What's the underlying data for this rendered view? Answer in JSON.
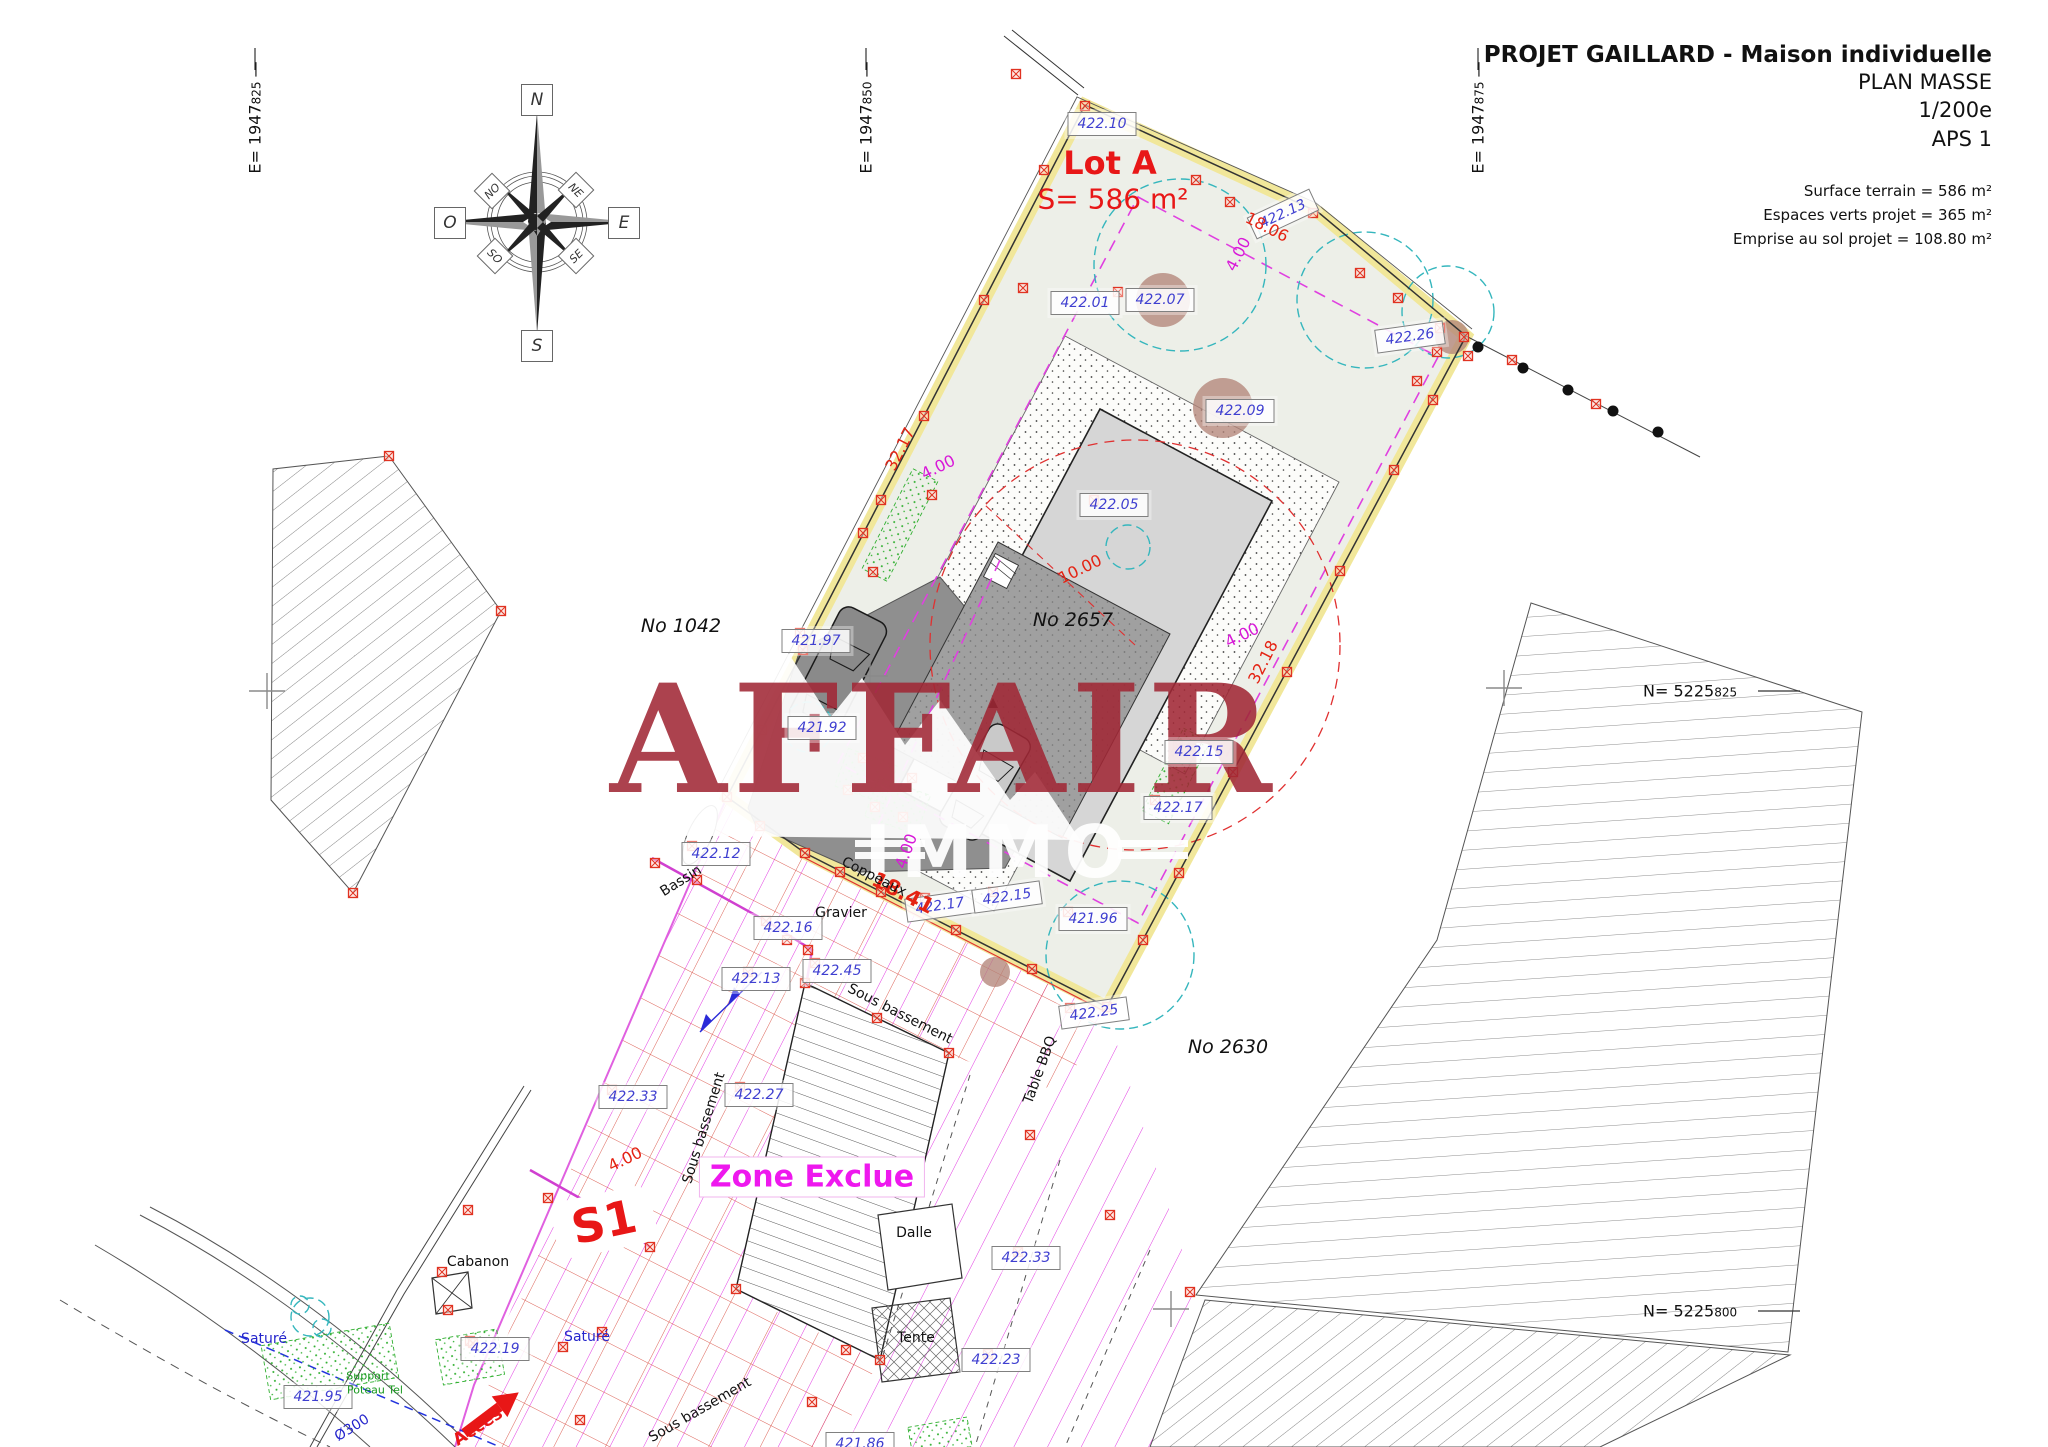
{
  "title_block": {
    "title": "PROJET GAILLARD - Maison individuelle",
    "subtitle": "PLAN MASSE",
    "scale": "1/200e",
    "phase": "APS 1",
    "surface_terrain": "Surface terrain = 586 m²",
    "espaces_verts": "Espaces verts projet = 365 m²",
    "emprise_sol": "Emprise au sol projet = 108.80 m²"
  },
  "grid": {
    "dash": " —",
    "e1": {
      "prefix": "E= 1947",
      "sub": "825"
    },
    "e2": {
      "prefix": "E= 1947",
      "sub": "850"
    },
    "e3": {
      "prefix": "E= 1947",
      "sub": "875"
    },
    "n1": {
      "prefix": "N= 5225",
      "sub": "825"
    },
    "n2": {
      "prefix": "N= 5225",
      "sub": "800"
    }
  },
  "compass": {
    "n": "N",
    "s": "S",
    "e": "E",
    "o": "O",
    "ne": "NE",
    "no": "NO",
    "se": "SE",
    "so": "SO"
  },
  "watermark": {
    "line1": "AFFAIR",
    "line2": "IMMO"
  },
  "annotations": [
    {
      "t": "Lot A",
      "x": 1110,
      "y": 163,
      "r": 0,
      "c": "lotn"
    },
    {
      "t": "S= 586 m²",
      "x": 1113,
      "y": 199,
      "r": 0,
      "c": "lota"
    },
    {
      "t": "S1",
      "x": 604,
      "y": 1222,
      "r": -12,
      "c": "s1"
    },
    {
      "t": "Zone Exclue",
      "x": 812,
      "y": 1177,
      "r": 0,
      "c": "ze"
    },
    {
      "t": "Accès",
      "x": 478,
      "y": 1427,
      "r": -33,
      "c": "acces"
    },
    {
      "t": "422.10",
      "x": 1102,
      "y": 124,
      "r": 0,
      "c": "elev"
    },
    {
      "t": "422.13",
      "x": 1283,
      "y": 214,
      "r": -25,
      "c": "elev"
    },
    {
      "t": "422.01",
      "x": 1085,
      "y": 303,
      "r": 0,
      "c": "elev"
    },
    {
      "t": "422.07",
      "x": 1160,
      "y": 300,
      "r": 0,
      "c": "elev"
    },
    {
      "t": "422.26",
      "x": 1410,
      "y": 337,
      "r": -8,
      "c": "elev"
    },
    {
      "t": "422.09",
      "x": 1240,
      "y": 411,
      "r": 0,
      "c": "elev"
    },
    {
      "t": "422.05",
      "x": 1114,
      "y": 505,
      "r": 0,
      "c": "elev"
    },
    {
      "t": "421.97",
      "x": 816,
      "y": 641,
      "r": 0,
      "c": "elev"
    },
    {
      "t": "421.92",
      "x": 822,
      "y": 728,
      "r": 0,
      "c": "elev"
    },
    {
      "t": "422.15",
      "x": 1199,
      "y": 752,
      "r": 0,
      "c": "elev"
    },
    {
      "t": "422.17",
      "x": 1178,
      "y": 808,
      "r": 0,
      "c": "elev"
    },
    {
      "t": "421.96",
      "x": 1093,
      "y": 919,
      "r": 0,
      "c": "elev"
    },
    {
      "t": "422.12",
      "x": 716,
      "y": 854,
      "r": 0,
      "c": "elev"
    },
    {
      "t": "422.16",
      "x": 788,
      "y": 928,
      "r": 0,
      "c": "elev"
    },
    {
      "t": "422.13",
      "x": 756,
      "y": 979,
      "r": 0,
      "c": "elev"
    },
    {
      "t": "422.45",
      "x": 837,
      "y": 971,
      "r": 0,
      "c": "elev"
    },
    {
      "t": "422.17",
      "x": 940,
      "y": 906,
      "r": -8,
      "c": "elev"
    },
    {
      "t": "422.15",
      "x": 1007,
      "y": 897,
      "r": -8,
      "c": "elev"
    },
    {
      "t": "422.25",
      "x": 1094,
      "y": 1013,
      "r": -8,
      "c": "elev"
    },
    {
      "t": "422.33",
      "x": 633,
      "y": 1097,
      "r": 0,
      "c": "elev"
    },
    {
      "t": "422.27",
      "x": 759,
      "y": 1095,
      "r": 0,
      "c": "elev"
    },
    {
      "t": "422.33",
      "x": 1026,
      "y": 1258,
      "r": 0,
      "c": "elev"
    },
    {
      "t": "422.23",
      "x": 996,
      "y": 1360,
      "r": 0,
      "c": "elev"
    },
    {
      "t": "422.19",
      "x": 495,
      "y": 1349,
      "r": 0,
      "c": "elev"
    },
    {
      "t": "421.95",
      "x": 318,
      "y": 1397,
      "r": 0,
      "c": "elev"
    },
    {
      "t": "421.86",
      "x": 860,
      "y": 1444,
      "r": 0,
      "c": "elev"
    },
    {
      "t": "18.06",
      "x": 1267,
      "y": 227,
      "r": 27,
      "c": "dimr"
    },
    {
      "t": "32.17",
      "x": 900,
      "y": 449,
      "r": -63,
      "c": "dimr"
    },
    {
      "t": "10.00",
      "x": 1080,
      "y": 569,
      "r": -26,
      "c": "dimr"
    },
    {
      "t": "32.18",
      "x": 1263,
      "y": 662,
      "r": -63,
      "c": "dimr"
    },
    {
      "t": "4.00",
      "x": 625,
      "y": 1159,
      "r": -26,
      "c": "dimr"
    },
    {
      "t": "18.41",
      "x": 903,
      "y": 893,
      "r": 27,
      "c": "dimrL"
    },
    {
      "t": "4.00",
      "x": 1238,
      "y": 254,
      "r": -63,
      "c": "dimm"
    },
    {
      "t": "4.00",
      "x": 938,
      "y": 467,
      "r": -26,
      "c": "dimm"
    },
    {
      "t": "4.00",
      "x": 1242,
      "y": 635,
      "r": -26,
      "c": "dimm"
    },
    {
      "t": "4.00",
      "x": 906,
      "y": 851,
      "r": -70,
      "c": "dimm"
    },
    {
      "t": "No 1042",
      "x": 681,
      "y": 626,
      "r": 0,
      "c": "parcel"
    },
    {
      "t": "No 2657",
      "x": 1073,
      "y": 620,
      "r": 0,
      "c": "parcel"
    },
    {
      "t": "No 2630",
      "x": 1228,
      "y": 1047,
      "r": 0,
      "c": "parcel"
    },
    {
      "t": "Bassin",
      "x": 681,
      "y": 881,
      "r": -32,
      "c": "site"
    },
    {
      "t": "Gravier",
      "x": 841,
      "y": 913,
      "r": 0,
      "c": "site"
    },
    {
      "t": "Coppeaux",
      "x": 874,
      "y": 877,
      "r": 27,
      "c": "site"
    },
    {
      "t": "Sous bassement",
      "x": 900,
      "y": 1014,
      "r": 27,
      "c": "site"
    },
    {
      "t": "Sous bassement",
      "x": 704,
      "y": 1128,
      "r": -73,
      "c": "site"
    },
    {
      "t": "Sous bassement",
      "x": 700,
      "y": 1410,
      "r": -30,
      "c": "site"
    },
    {
      "t": "Cabanon",
      "x": 478,
      "y": 1262,
      "r": 0,
      "c": "site"
    },
    {
      "t": "Dalle",
      "x": 914,
      "y": 1233,
      "r": 0,
      "c": "site"
    },
    {
      "t": "Tente",
      "x": 916,
      "y": 1338,
      "r": 0,
      "c": "site"
    },
    {
      "t": "Table BBQ",
      "x": 1040,
      "y": 1070,
      "r": -70,
      "c": "site"
    },
    {
      "t": "Saturé",
      "x": 264,
      "y": 1339,
      "r": 0,
      "c": "siteb"
    },
    {
      "t": "Saturé",
      "x": 587,
      "y": 1337,
      "r": 0,
      "c": "siteb"
    },
    {
      "t": "Ø300",
      "x": 352,
      "y": 1428,
      "r": -32,
      "c": "siteb"
    },
    {
      "t": "Support",
      "x": 368,
      "y": 1376,
      "r": 0,
      "c": "siteg"
    },
    {
      "t": "Poteau Tel",
      "x": 375,
      "y": 1390,
      "r": 0,
      "c": "siteg"
    }
  ]
}
